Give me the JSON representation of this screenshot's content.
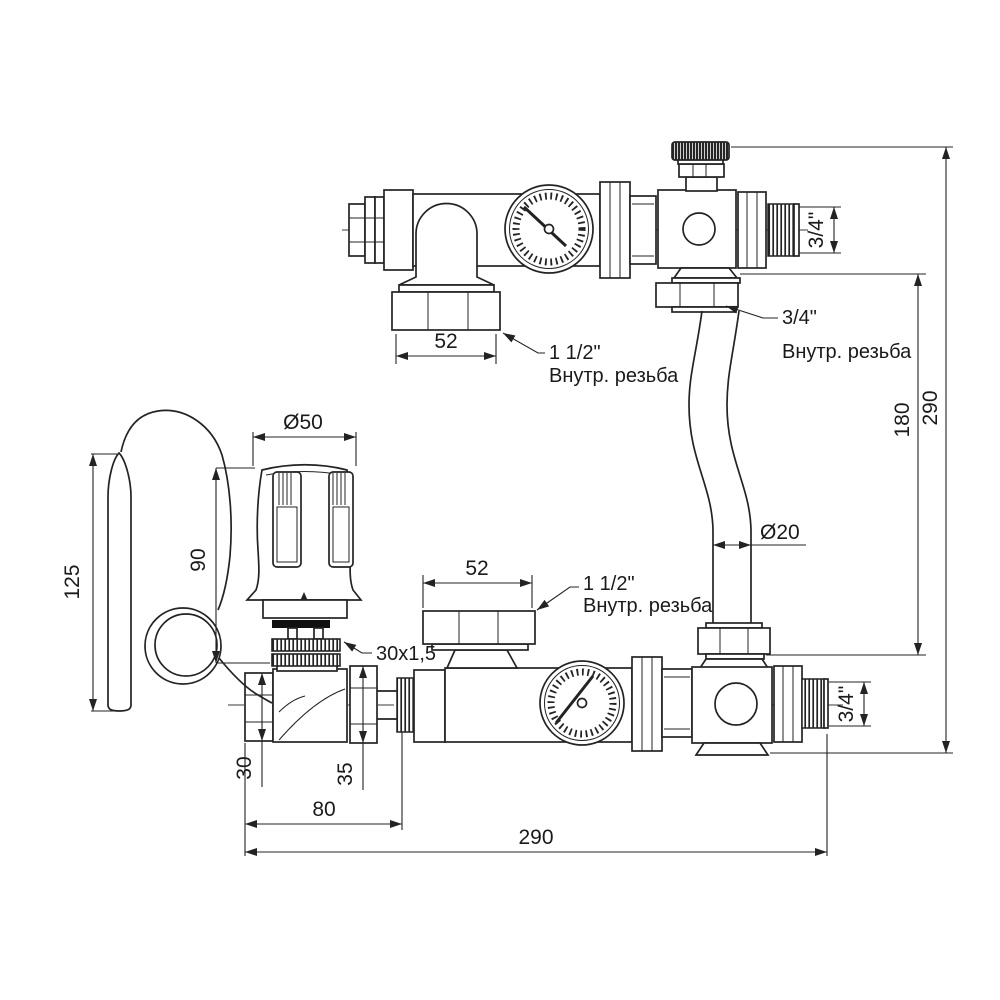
{
  "drawing": {
    "background": "#ffffff",
    "line_color": "#232323",
    "dims": {
      "top_52": "52",
      "top_thread_note_l1": "1 1/2\"",
      "top_thread_note_l2": "Внутр. резьба",
      "top_out_34": "3/4\"",
      "pipe_nut_note_l1": "3/4\"",
      "pipe_nut_note_l2": "Внутр. резьба",
      "pipe_dia": "Ø20",
      "right_290": "290",
      "right_180": "180",
      "head_dia": "Ø50",
      "head_height": "90",
      "probe_len": "125",
      "adapter_thread": "30x1,5",
      "bottom_52": "52",
      "bottom_thread_note_l1": "1 1/2\"",
      "bottom_thread_note_l2": "Внутр. резьба",
      "hex_30": "30",
      "union_35": "35",
      "bottom_80": "80",
      "bottom_290": "290",
      "bottom_out_34": "3/4\""
    }
  }
}
